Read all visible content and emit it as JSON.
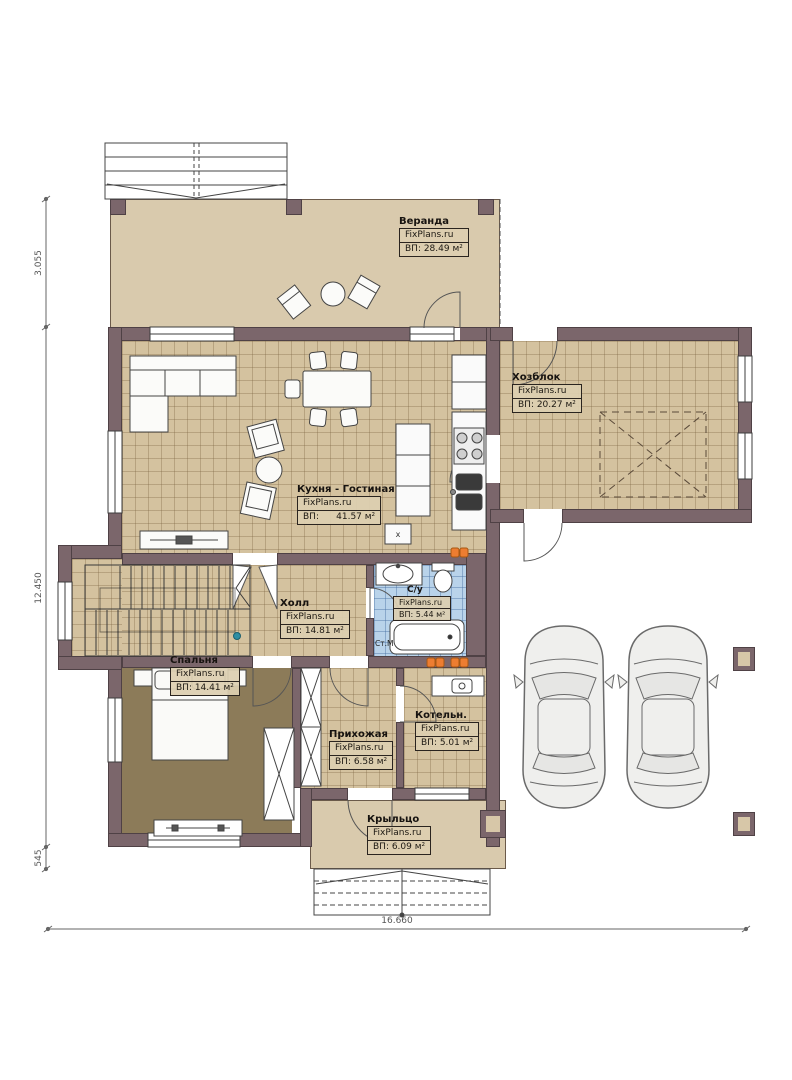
{
  "plan": {
    "brand": "FixPlans.ru",
    "rooms": [
      {
        "id": "veranda",
        "name": "Веранда",
        "brand": "FixPlans.ru",
        "area": "ВП: 28.49 м²"
      },
      {
        "id": "hozblok",
        "name": "Хозблок",
        "brand": "FixPlans.ru",
        "area": "ВП: 20.27 м²"
      },
      {
        "id": "kitchen_living",
        "name": "Кухня - Гостиная",
        "brand": "FixPlans.ru",
        "area": "ВП:      41.57 м²"
      },
      {
        "id": "hall",
        "name": "Холл",
        "brand": "FixPlans.ru",
        "area": "ВП: 14.81 м²"
      },
      {
        "id": "bathroom",
        "name": "С/у",
        "brand": "FixPlans.ru",
        "area": "ВП: 5.44 м²"
      },
      {
        "id": "bedroom",
        "name": "Спальня",
        "brand": "FixPlans.ru",
        "area": "ВП: 14.41 м²"
      },
      {
        "id": "prihozhaya",
        "name": "Прихожая",
        "brand": "FixPlans.ru",
        "area": "ВП: 6.58 м²"
      },
      {
        "id": "boiler",
        "name": "Котельн.",
        "brand": "FixPlans.ru",
        "area": "ВП: 5.01 м²"
      },
      {
        "id": "porch",
        "name": "Крыльцо",
        "brand": "FixPlans.ru",
        "area": "ВП: 6.09 м²"
      }
    ],
    "dimensions": {
      "left_top": "3.055",
      "left_mid": "12.450",
      "left_bottom": "545",
      "bottom_width": "16.660"
    },
    "annotations": {
      "washing_machine": "Ст.М",
      "duct": "x"
    },
    "colors": {
      "wall": "#7b666b",
      "floor_tan": "#d4c29f",
      "floor_bedroom": "#8c7b59",
      "floor_bath": "#b9d3ea",
      "veranda": "#d9caad",
      "radiator": "#ed7d31"
    }
  }
}
